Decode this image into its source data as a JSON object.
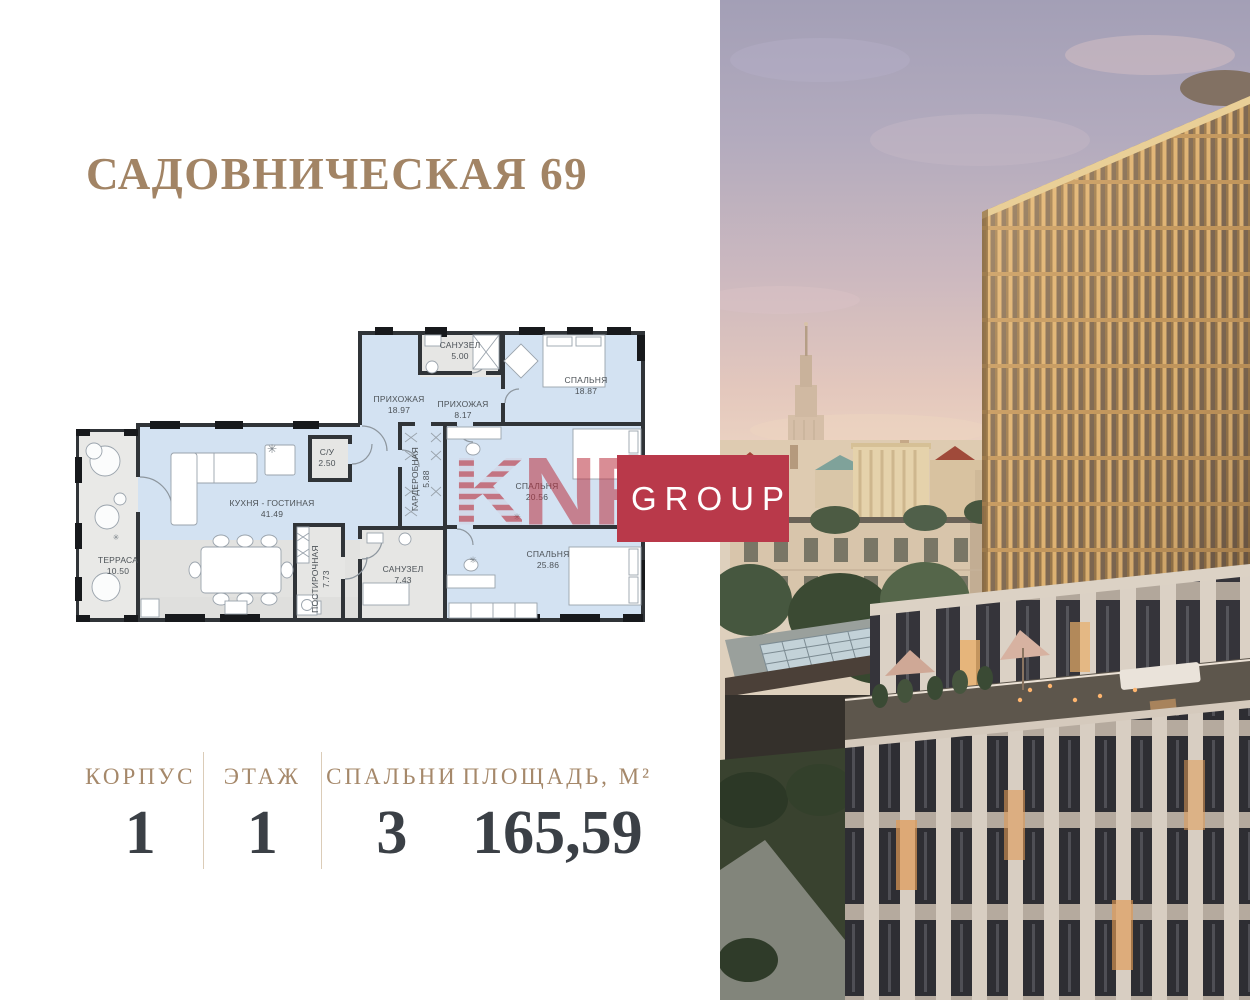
{
  "title": "САДОВНИЧЕСКАЯ 69",
  "watermark": {
    "k": "K",
    "n": "N",
    "f": "F",
    "group": "GROUP"
  },
  "plan": {
    "deco": "✳",
    "rooms": [
      {
        "name": "ПРИХОЖАЯ",
        "area": "18.97"
      },
      {
        "name": "САНУЗЕЛ",
        "area": "5.00"
      },
      {
        "name": "СПАЛЬНЯ",
        "area": "18.87"
      },
      {
        "name": "ПРИХОЖАЯ",
        "area": "8.17"
      },
      {
        "name": "С/У",
        "area": "2.50"
      },
      {
        "name": "ГАРДЕРОБНАЯ",
        "area": "5.88"
      },
      {
        "name": "СПАЛЬНЯ",
        "area": "20.56"
      },
      {
        "name": "СПАЛЬНЯ",
        "area": "25.86"
      },
      {
        "name": "САНУЗЕЛ",
        "area": "7.43"
      },
      {
        "name": "ПОСТИРОЧНАЯ",
        "area": "7.73"
      },
      {
        "name": "КУХНЯ - ГОСТИНАЯ",
        "area": "41.49"
      },
      {
        "name": "ТЕРРАСА",
        "area": "10.50"
      }
    ]
  },
  "stats": {
    "items": [
      {
        "label": "КОРПУС",
        "value": "1"
      },
      {
        "label": "ЭТАЖ",
        "value": "1"
      },
      {
        "label": "СПАЛЬНИ",
        "value": "3"
      },
      {
        "label": "ПЛОЩАДЬ, М²",
        "value": "165,59"
      }
    ]
  },
  "colors": {
    "accent_gold": "#a28465",
    "stat_number": "#3b4046",
    "watermark_red": "#b9394a",
    "plan_room_fill": "#d3e2f2",
    "plan_wall": "#303438"
  }
}
